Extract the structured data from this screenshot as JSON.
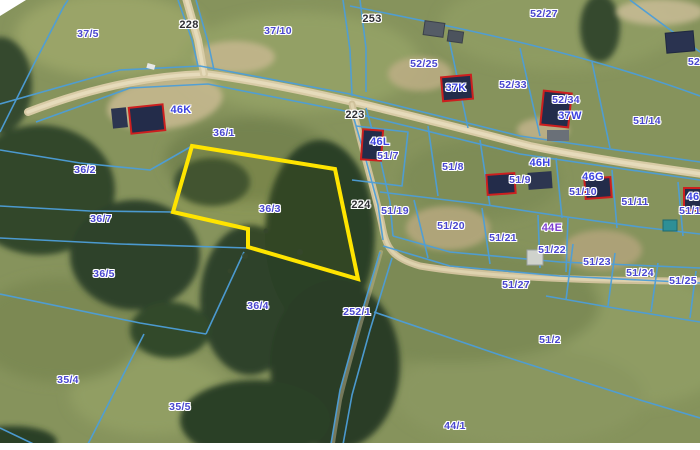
{
  "map": {
    "type": "cadastral-aerial-map",
    "highlighted_parcel": {
      "id": "36/3",
      "outline_color": "#ffe400"
    },
    "colors": {
      "boundary_line": "#4d9ed8",
      "building_fill": "#232c4a",
      "building_outline": "#cc1f1f",
      "road_surface": "#d8cba6",
      "label_parcel": "#4946cf",
      "label_road": "#2e2e33",
      "label_building": "#3c43e0",
      "label_building_alt": "#7d3ed1"
    },
    "labels": [
      {
        "t": "37/5",
        "x": 88,
        "y": 34,
        "k": "parcel"
      },
      {
        "t": "228",
        "x": 189,
        "y": 25,
        "k": "road"
      },
      {
        "t": "37/10",
        "x": 278,
        "y": 31,
        "k": "parcel"
      },
      {
        "t": "253",
        "x": 372,
        "y": 19,
        "k": "road"
      },
      {
        "t": "52/27",
        "x": 544,
        "y": 14,
        "k": "parcel"
      },
      {
        "t": "52",
        "x": 694,
        "y": 62,
        "k": "parcel"
      },
      {
        "t": "52/25",
        "x": 424,
        "y": 64,
        "k": "parcel"
      },
      {
        "t": "52/33",
        "x": 513,
        "y": 85,
        "k": "parcel"
      },
      {
        "t": "52/34",
        "x": 566,
        "y": 100,
        "k": "parcel"
      },
      {
        "t": "37W",
        "x": 570,
        "y": 116,
        "k": "building"
      },
      {
        "t": "37K",
        "x": 456,
        "y": 88,
        "k": "building"
      },
      {
        "t": "51/14",
        "x": 647,
        "y": 121,
        "k": "parcel"
      },
      {
        "t": "46K",
        "x": 181,
        "y": 110,
        "k": "building"
      },
      {
        "t": "223",
        "x": 355,
        "y": 115,
        "k": "road"
      },
      {
        "t": "36/1",
        "x": 224,
        "y": 133,
        "k": "parcel"
      },
      {
        "t": "46L",
        "x": 380,
        "y": 142,
        "k": "building"
      },
      {
        "t": "51/7",
        "x": 388,
        "y": 156,
        "k": "parcel"
      },
      {
        "t": "51/8",
        "x": 453,
        "y": 167,
        "k": "parcel"
      },
      {
        "t": "46H",
        "x": 540,
        "y": 163,
        "k": "building"
      },
      {
        "t": "51/9",
        "x": 520,
        "y": 180,
        "k": "parcel"
      },
      {
        "t": "46G",
        "x": 593,
        "y": 177,
        "k": "building"
      },
      {
        "t": "51/10",
        "x": 583,
        "y": 192,
        "k": "parcel"
      },
      {
        "t": "51/11",
        "x": 635,
        "y": 202,
        "k": "parcel"
      },
      {
        "t": "46",
        "x": 693,
        "y": 197,
        "k": "building"
      },
      {
        "t": "51/1",
        "x": 690,
        "y": 211,
        "k": "parcel"
      },
      {
        "t": "36/2",
        "x": 85,
        "y": 170,
        "k": "parcel"
      },
      {
        "t": "36/7",
        "x": 101,
        "y": 219,
        "k": "parcel"
      },
      {
        "t": "36/3",
        "x": 270,
        "y": 209,
        "k": "parcel"
      },
      {
        "t": "224",
        "x": 361,
        "y": 205,
        "k": "road"
      },
      {
        "t": "51/19",
        "x": 395,
        "y": 211,
        "k": "parcel"
      },
      {
        "t": "51/20",
        "x": 451,
        "y": 226,
        "k": "parcel"
      },
      {
        "t": "51/21",
        "x": 503,
        "y": 238,
        "k": "parcel"
      },
      {
        "t": "44E",
        "x": 552,
        "y": 228,
        "k": "building-alt"
      },
      {
        "t": "51/22",
        "x": 552,
        "y": 250,
        "k": "parcel"
      },
      {
        "t": "51/23",
        "x": 597,
        "y": 262,
        "k": "parcel"
      },
      {
        "t": "51/24",
        "x": 640,
        "y": 273,
        "k": "parcel"
      },
      {
        "t": "51/25",
        "x": 683,
        "y": 281,
        "k": "parcel"
      },
      {
        "t": "51/27",
        "x": 516,
        "y": 285,
        "k": "parcel"
      },
      {
        "t": "36/5",
        "x": 104,
        "y": 274,
        "k": "parcel"
      },
      {
        "t": "36/4",
        "x": 258,
        "y": 306,
        "k": "parcel"
      },
      {
        "t": "252/1",
        "x": 357,
        "y": 312,
        "k": "parcel"
      },
      {
        "t": "51/2",
        "x": 550,
        "y": 340,
        "k": "parcel"
      },
      {
        "t": "35/4",
        "x": 68,
        "y": 380,
        "k": "parcel"
      },
      {
        "t": "35/5",
        "x": 180,
        "y": 407,
        "k": "parcel"
      },
      {
        "t": "44/1",
        "x": 455,
        "y": 426,
        "k": "parcel"
      }
    ]
  }
}
